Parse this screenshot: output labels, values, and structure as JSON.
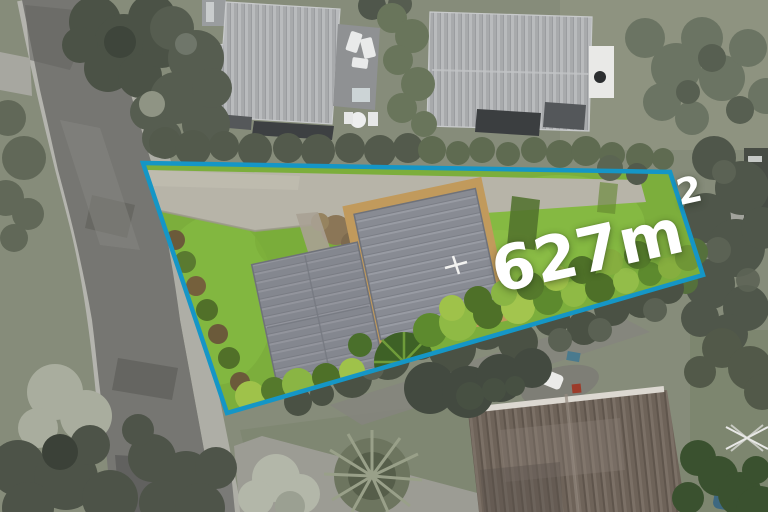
{
  "scene": {
    "kind": "aerial-property-photo",
    "area_label": {
      "value": "627m",
      "superscript": "2"
    },
    "colors": {
      "boundary_line": "#1596c6",
      "area_text": "#ffffff",
      "lot_lawn": "#7cae3c",
      "subject_roof": "#888b93",
      "road_asphalt": "#767672",
      "outside_base": "#868c7a"
    }
  }
}
